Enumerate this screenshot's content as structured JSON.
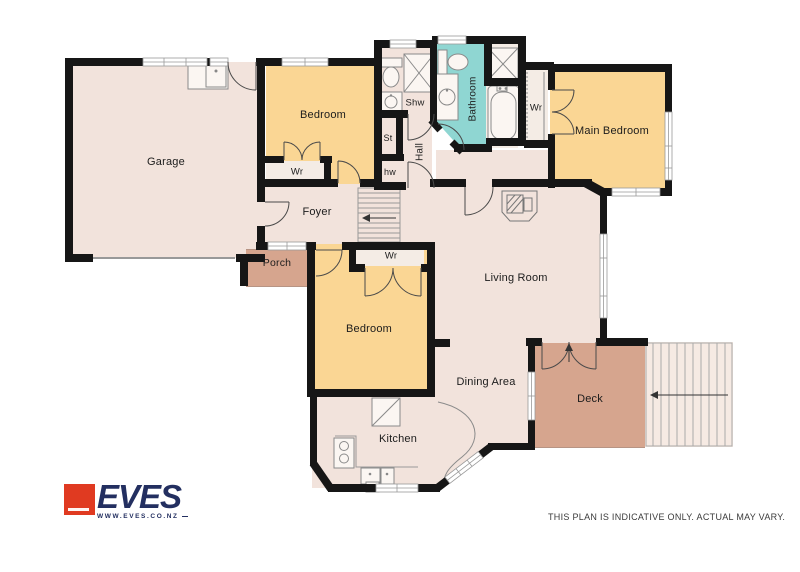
{
  "plan": {
    "rooms": {
      "garage": "Garage",
      "bedroom_top": "Bedroom",
      "wr_top": "Wr",
      "shw": "Shw",
      "st": "St",
      "hw": "hw",
      "hall": "Hall",
      "bathroom": "Bathroom",
      "wr_main": "Wr",
      "main_bedroom": "Main Bedroom",
      "foyer": "Foyer",
      "porch": "Porch",
      "wr_bottom": "Wr",
      "bedroom_bottom": "Bedroom",
      "living_room": "Living Room",
      "dining_area": "Dining Area",
      "kitchen": "Kitchen",
      "deck": "Deck"
    },
    "colors": {
      "wall": "#161616",
      "floor": "#F2E3DC",
      "bedroom_fill": "#FAD694",
      "bathroom_fill": "#8FD6D2",
      "deck_fill": "#D6A58E",
      "closet_fill": "#F4ECE5"
    }
  },
  "footer": {
    "logo_text": "EVES",
    "logo_url": "WWW.EVES.CO.NZ",
    "disclaimer": "THIS PLAN IS INDICATIVE ONLY. ACTUAL MAY VARY."
  }
}
